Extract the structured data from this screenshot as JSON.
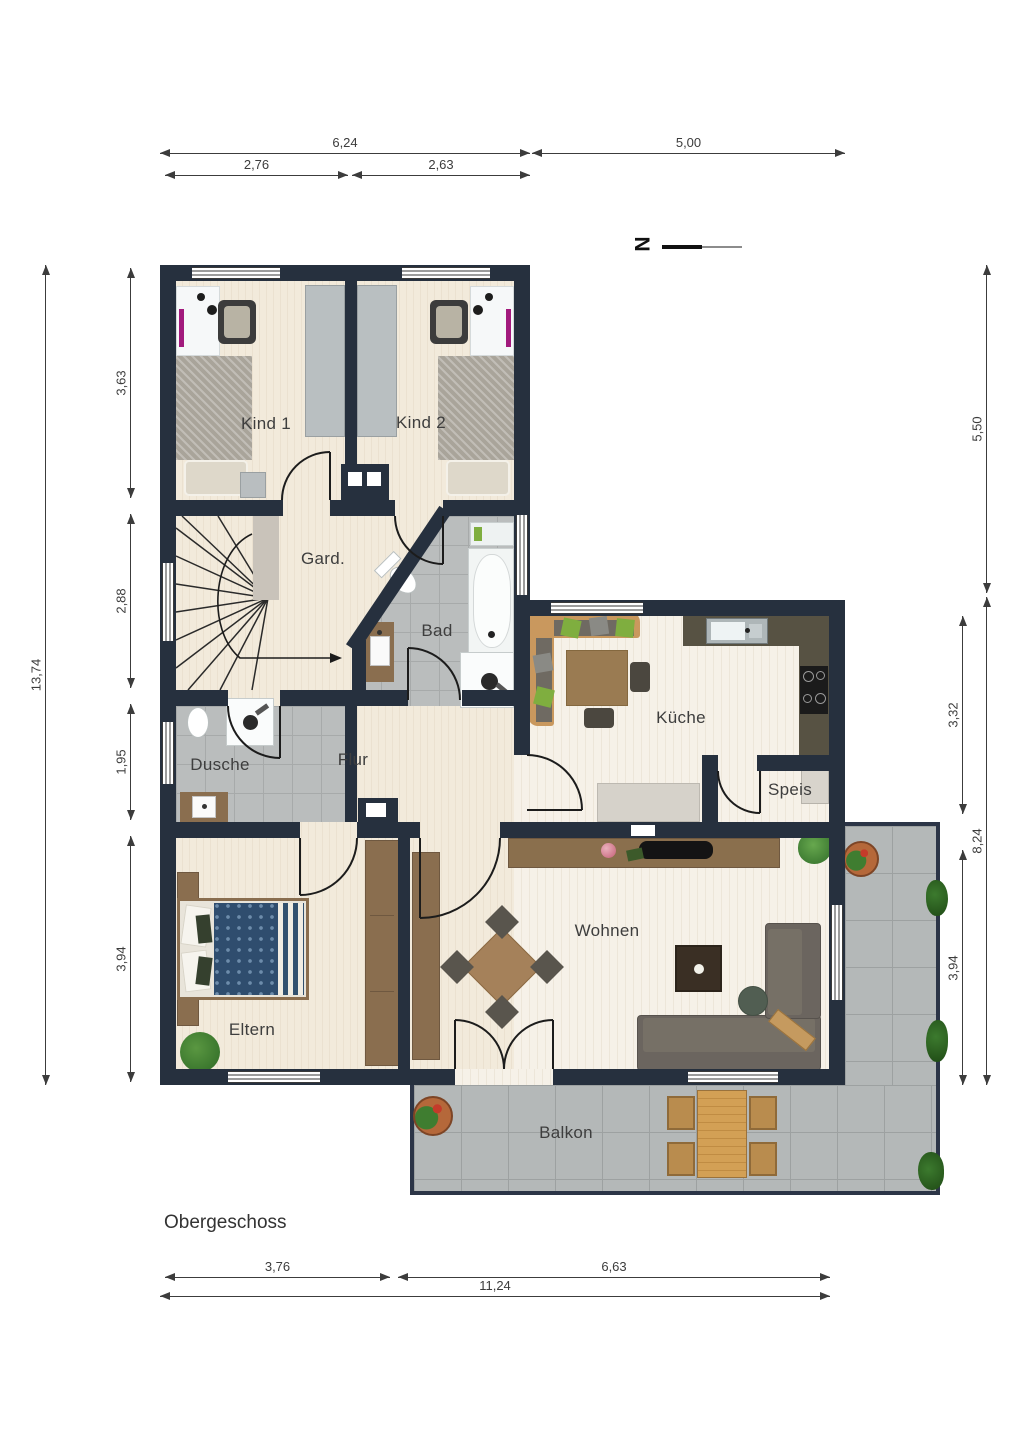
{
  "title": "Obergeschoss",
  "north": {
    "label": "N"
  },
  "rooms": {
    "kind1": "Kind 1",
    "kind2": "Kind 2",
    "gard": "Gard.",
    "bad": "Bad",
    "kueche": "Küche",
    "speis": "Speis",
    "dusche": "Dusche",
    "flur": "Flur",
    "eltern": "Eltern",
    "wohnen": "Wohnen",
    "balkon": "Balkon"
  },
  "dims": {
    "top_total_left": "6,24",
    "top_total_right": "5,00",
    "top_sub_left": "2,76",
    "top_sub_right": "2,63",
    "left_total": "13,74",
    "left_1": "3,63",
    "left_2": "2,88",
    "left_3": "1,95",
    "left_4": "3,94",
    "right_1": "5,50",
    "right_2": "8,24",
    "right_inner_1": "3,32",
    "right_inner_2": "3,94",
    "bottom_sub_left": "3,76",
    "bottom_sub_right": "6,63",
    "bottom_total": "11,24"
  },
  "palette": {
    "wall": "#26303e",
    "wood_floor": "#f2eadb",
    "wood_floor_light": "#f6f1e8",
    "bath_tile": "#babdbd",
    "balcony_tile": "#b4b8b8",
    "furniture_wood": "#8a6e4f",
    "accent_green": "#7fae3f"
  }
}
